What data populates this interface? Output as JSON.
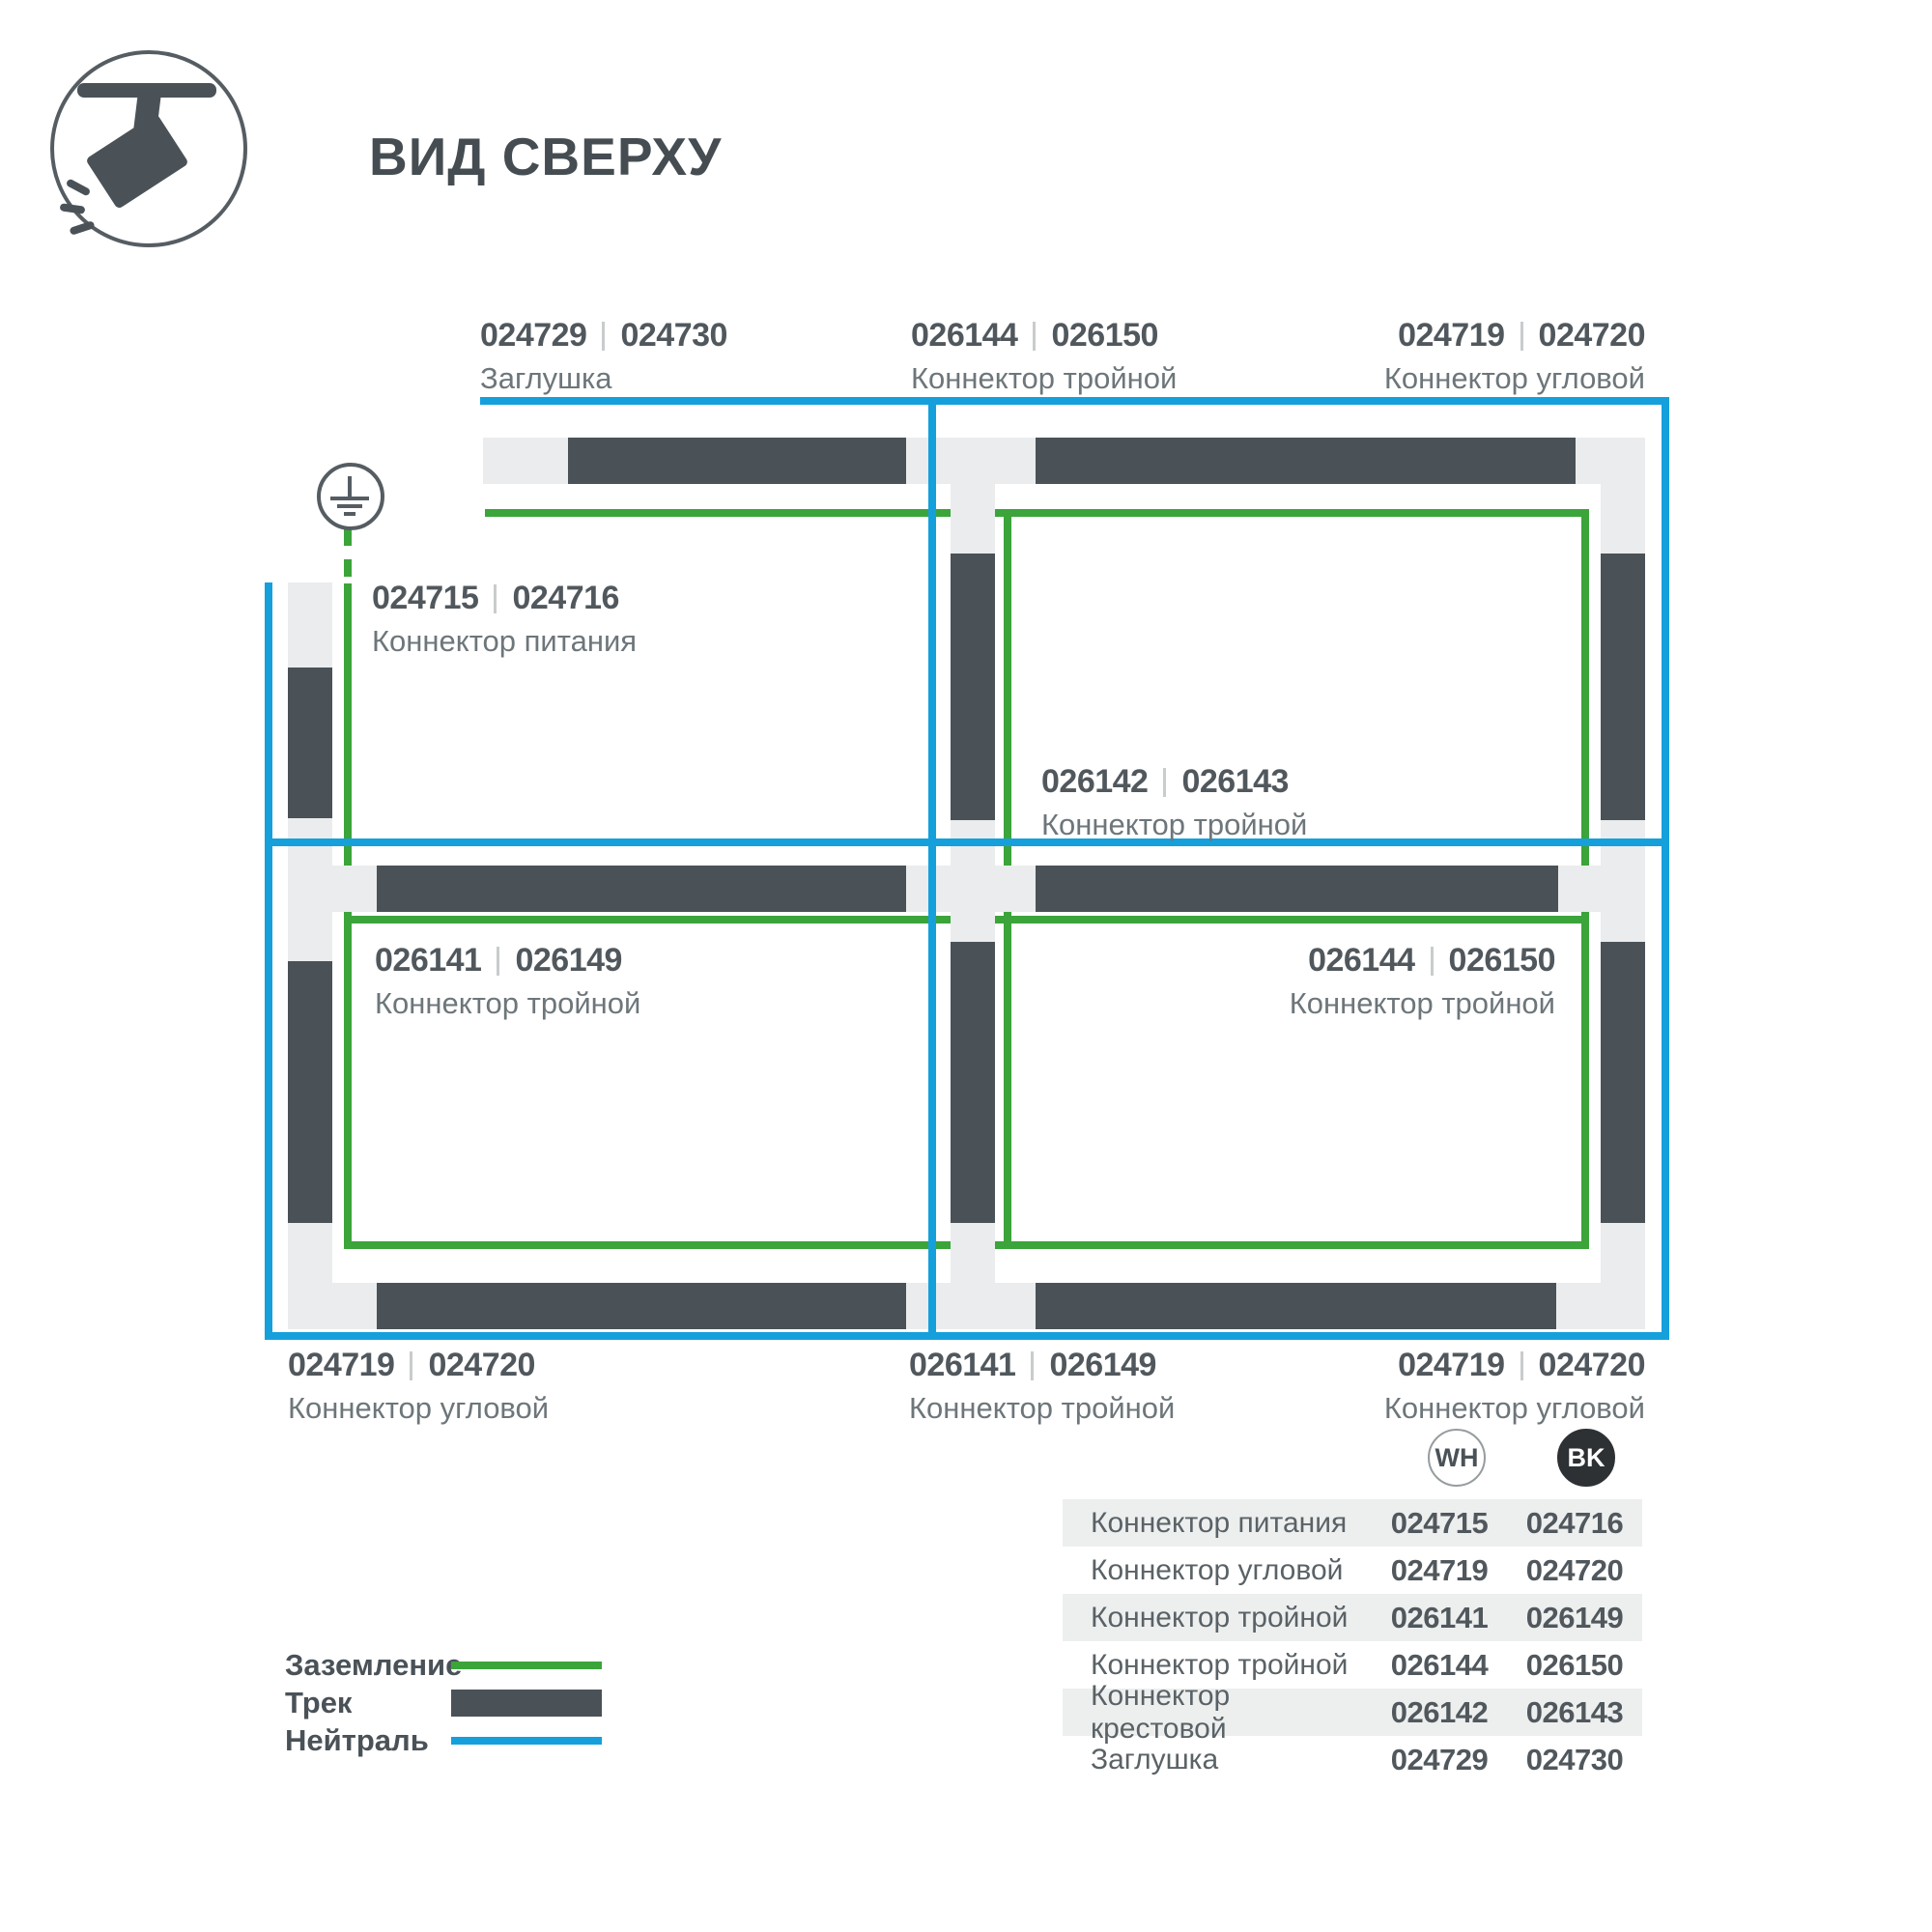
{
  "brand": {
    "title": "ВИД СВЕРХУ",
    "icon": "track-light-icon"
  },
  "colors": {
    "track": "#4a5258",
    "connector_block": "#eaeced",
    "ground_green": "#3ba43a",
    "neutral_blue": "#15a0dc",
    "number_text": "#51585d",
    "name_text": "#6d767a",
    "bk_badge": "#2d3134"
  },
  "labels": {
    "top_endcap": {
      "wh": "024729",
      "bk": "024730",
      "name": "Заглушка"
    },
    "top_tee": {
      "wh": "026144",
      "bk": "026150",
      "name": "Коннектор тройной"
    },
    "top_corner": {
      "wh": "024719",
      "bk": "024720",
      "name": "Коннектор угловой"
    },
    "power": {
      "wh": "024715",
      "bk": "024716",
      "name": "Коннектор питания"
    },
    "cross": {
      "wh": "026142",
      "bk": "026143",
      "name": "Коннектор тройной"
    },
    "bottom_left_cell": {
      "wh": "026141",
      "bk": "026149",
      "name": "Коннектор тройной"
    },
    "bottom_right_cell": {
      "wh": "026144",
      "bk": "026150",
      "name": "Коннектор тройной"
    },
    "bottom_corner_left": {
      "wh": "024719",
      "bk": "024720",
      "name": "Коннектор угловой"
    },
    "bottom_tee": {
      "wh": "026141",
      "bk": "026149",
      "name": "Коннектор тройной"
    },
    "bottom_corner_right": {
      "wh": "024719",
      "bk": "024720",
      "name": "Коннектор угловой"
    }
  },
  "legend": {
    "items": [
      {
        "label": "Заземление",
        "swatch": "green-line"
      },
      {
        "label": "Трек",
        "swatch": "dark-bar"
      },
      {
        "label": "Нейтраль",
        "swatch": "blue-line"
      }
    ]
  },
  "table": {
    "columns": {
      "wh": "WH",
      "bk": "BK"
    },
    "rows": [
      {
        "name": "Коннектор питания",
        "wh": "024715",
        "bk": "024716"
      },
      {
        "name": "Коннектор угловой",
        "wh": "024719",
        "bk": "024720"
      },
      {
        "name": "Коннектор тройной",
        "wh": "026141",
        "bk": "026149"
      },
      {
        "name": "Коннектор тройной",
        "wh": "026144",
        "bk": "026150"
      },
      {
        "name": "Коннектор крестовой",
        "wh": "026142",
        "bk": "026143"
      },
      {
        "name": "Заглушка",
        "wh": "024729",
        "bk": "024730"
      }
    ]
  }
}
